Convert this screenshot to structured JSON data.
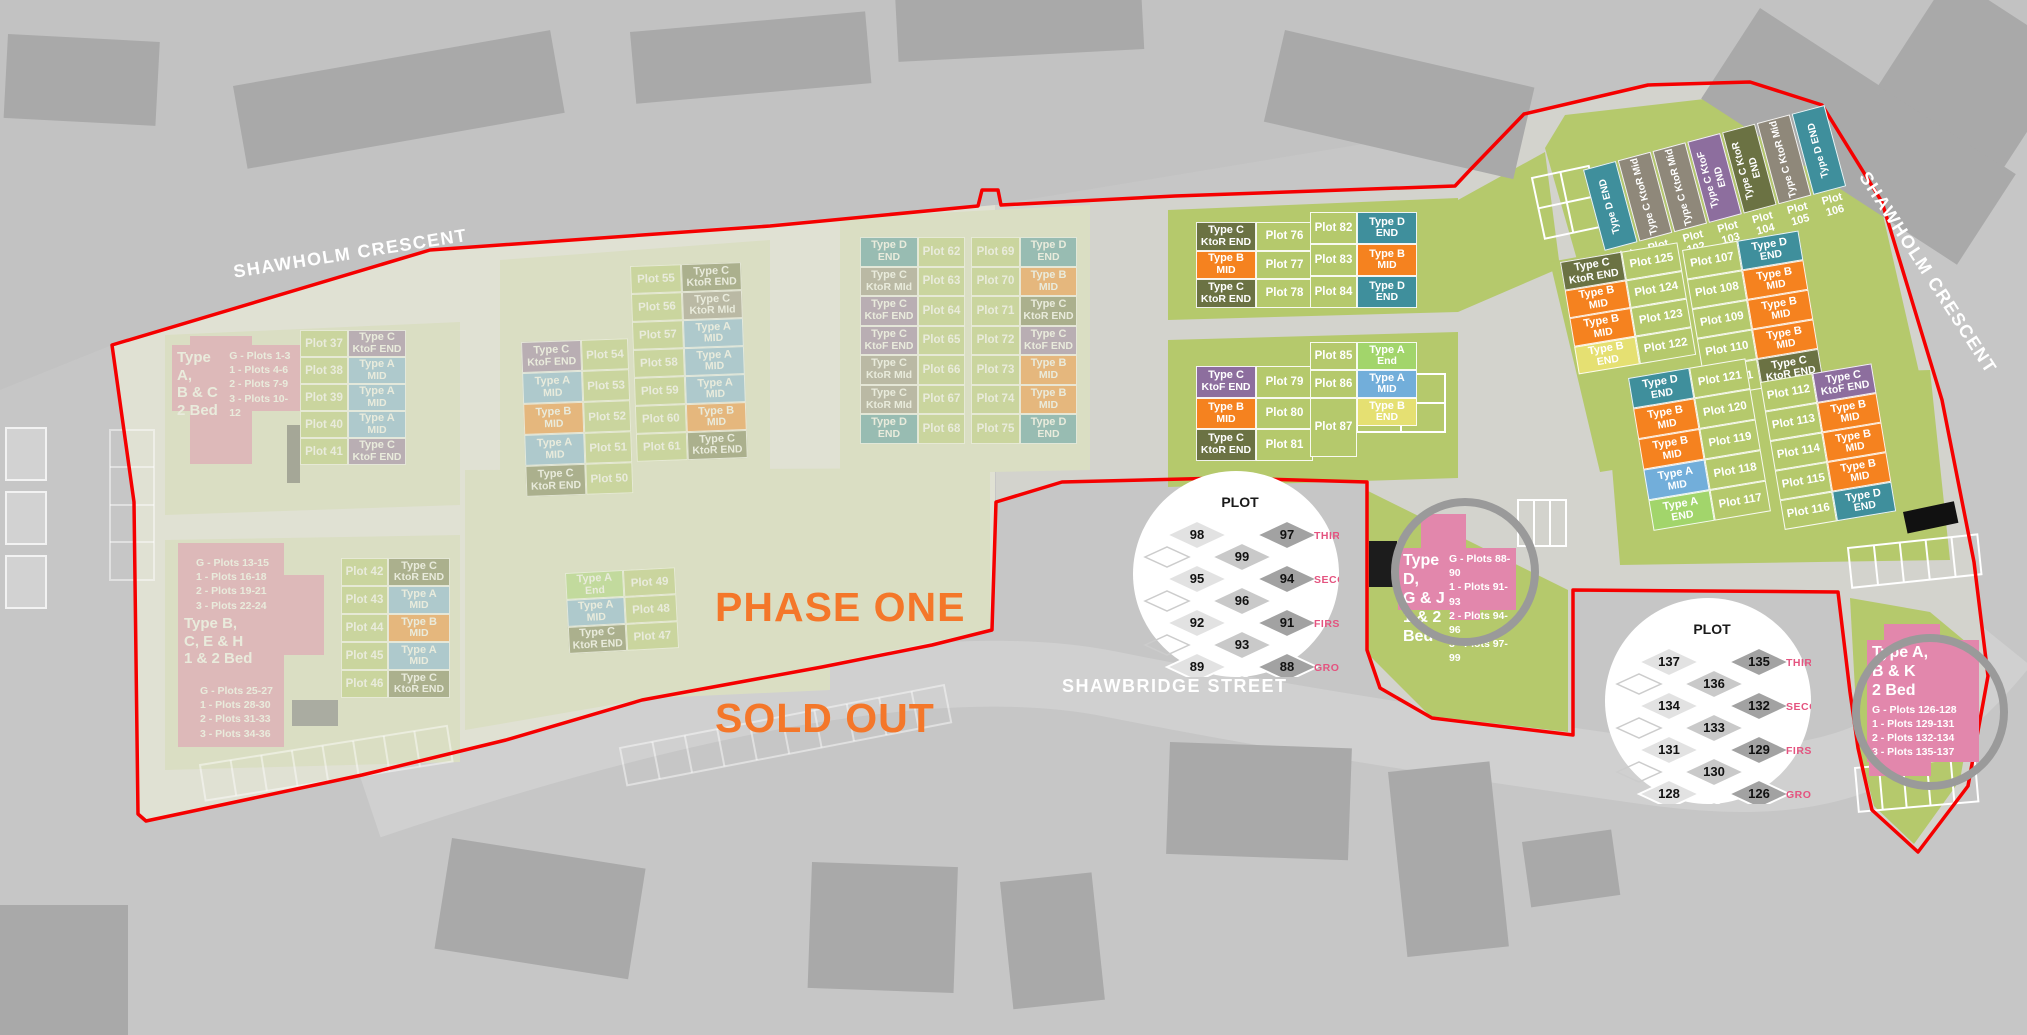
{
  "streets": {
    "shawholm_top": "SHAWHOLM CRESCENT",
    "shawholm_right": "SHAWHOLM CRESCENT",
    "shawbridge": "SHAWBRIDGE STREET"
  },
  "banner": {
    "line1": "PHASE ONE",
    "line2": "SOLD OUT"
  },
  "type_colors": {
    "A_MID": "#72AEDA",
    "A_END": "#A2D56B",
    "B_MID": "#F5821F",
    "B_END": "#E5E072",
    "C_KTOR_END": "#6B7243",
    "C_KTOR_MID": "#8F887A",
    "C_KTOF_END": "#8D6E9E",
    "D_END": "#3F8F9C"
  },
  "palette": {
    "plot_green": "#B5C96C",
    "boundary_red": "#F50000",
    "info_pink": "#E287AC",
    "floor_label_pink": "#E4537F",
    "banner_orange": "#F4772A"
  },
  "clusters": [
    {
      "id": "c76",
      "rows": [
        {
          "plot": "Plot 76",
          "l1": "Type C",
          "l2": "KtoR END",
          "c": "C_KTOR_END"
        },
        {
          "plot": "Plot 77",
          "l1": "Type B",
          "l2": "MID",
          "c": "B_MID"
        },
        {
          "plot": "Plot 78",
          "l1": "Type C",
          "l2": "KtoR END",
          "c": "C_KTOR_END"
        }
      ]
    },
    {
      "id": "c82",
      "rows": [
        {
          "plot": "Plot 82",
          "l1": "Type D",
          "l2": "END",
          "c": "D_END"
        },
        {
          "plot": "Plot 83",
          "l1": "Type B",
          "l2": "MID",
          "c": "B_MID"
        },
        {
          "plot": "Plot 84",
          "l1": "Type D",
          "l2": "END",
          "c": "D_END"
        }
      ]
    },
    {
      "id": "c79",
      "rows": [
        {
          "plot": "Plot 79",
          "l1": "Type C",
          "l2": "KtoF END",
          "c": "C_KTOF_END"
        },
        {
          "plot": "Plot 80",
          "l1": "Type B",
          "l2": "MID",
          "c": "B_MID"
        },
        {
          "plot": "Plot 81",
          "l1": "Type C",
          "l2": "KtoR END",
          "c": "C_KTOR_END"
        }
      ]
    },
    {
      "id": "c85",
      "rows": [
        {
          "plot": "Plot 85",
          "l1": "Type A",
          "l2": "End",
          "c": "A_END"
        },
        {
          "plot": "Plot 86",
          "l1": "Type A",
          "l2": "MID",
          "c": "A_MID"
        },
        {
          "plot": "Plot 87",
          "l1": "Type B",
          "l2": "END",
          "c": "B_END"
        }
      ]
    },
    {
      "id": "c100",
      "rows": [
        {
          "plot": "Plot 100",
          "l1": "Type D",
          "l2": "END",
          "c": "D_END"
        },
        {
          "plot": "Plot 101",
          "l1": "Type C",
          "l2": "KtoR Mid",
          "c": "C_KTOR_MID"
        },
        {
          "plot": "Plot 102",
          "l1": "Type C",
          "l2": "KtoR Mid",
          "c": "C_KTOR_MID"
        },
        {
          "plot": "Plot 103",
          "l1": "Type C",
          "l2": "KtoF END",
          "c": "C_KTOF_END"
        },
        {
          "plot": "Plot 104",
          "l1": "Type C",
          "l2": "KtoR END",
          "c": "C_KTOR_END"
        },
        {
          "plot": "Plot 105",
          "l1": "Type C",
          "l2": "KtoR Mid",
          "c": "C_KTOR_MID"
        },
        {
          "plot": "Plot 106",
          "l1": "Type D",
          "l2": "END",
          "c": "D_END"
        }
      ]
    },
    {
      "id": "c125",
      "rows": [
        {
          "plot": "Plot 125",
          "l1": "Type C",
          "l2": "KtoR END",
          "c": "C_KTOR_END"
        },
        {
          "plot": "Plot 124",
          "l1": "Type B",
          "l2": "MID",
          "c": "B_MID"
        },
        {
          "plot": "Plot 123",
          "l1": "Type B",
          "l2": "MID",
          "c": "B_MID"
        },
        {
          "plot": "Plot 122",
          "l1": "Type B",
          "l2": "END",
          "c": "B_END"
        }
      ]
    },
    {
      "id": "c107",
      "rows": [
        {
          "plot": "Plot 107",
          "l1": "Type D",
          "l2": "END",
          "c": "D_END"
        },
        {
          "plot": "Plot 108",
          "l1": "Type B",
          "l2": "MID",
          "c": "B_MID"
        },
        {
          "plot": "Plot 109",
          "l1": "Type B",
          "l2": "MID",
          "c": "B_MID"
        },
        {
          "plot": "Plot 110",
          "l1": "Type B",
          "l2": "MID",
          "c": "B_MID"
        },
        {
          "plot": "Plot 111",
          "l1": "Type C",
          "l2": "KtoR END",
          "c": "C_KTOR_END"
        }
      ]
    },
    {
      "id": "c121",
      "rows": [
        {
          "plot": "Plot 121",
          "l1": "Type D",
          "l2": "END",
          "c": "D_END"
        },
        {
          "plot": "Plot 120",
          "l1": "Type B",
          "l2": "MID",
          "c": "B_MID"
        },
        {
          "plot": "Plot 119",
          "l1": "Type B",
          "l2": "MID",
          "c": "B_MID"
        },
        {
          "plot": "Plot 118",
          "l1": "Type A",
          "l2": "MID",
          "c": "A_MID"
        },
        {
          "plot": "Plot 117",
          "l1": "Type A",
          "l2": "END",
          "c": "A_END"
        }
      ]
    },
    {
      "id": "c112",
      "rows": [
        {
          "plot": "Plot 112",
          "l1": "Type C",
          "l2": "KtoF END",
          "c": "C_KTOF_END"
        },
        {
          "plot": "Plot 113",
          "l1": "Type B",
          "l2": "MID",
          "c": "B_MID"
        },
        {
          "plot": "Plot 114",
          "l1": "Type B",
          "l2": "MID",
          "c": "B_MID"
        },
        {
          "plot": "Plot 115",
          "l1": "Type B",
          "l2": "MID",
          "c": "B_MID"
        },
        {
          "plot": "Plot 116",
          "l1": "Type D",
          "l2": "END",
          "c": "D_END"
        }
      ]
    },
    {
      "id": "f37",
      "faded": true,
      "rows": [
        {
          "plot": "Plot 37",
          "l1": "Type C",
          "l2": "KtoF END",
          "c": "C_KTOF_END"
        },
        {
          "plot": "Plot 38",
          "l1": "Type A",
          "l2": "MID",
          "c": "A_MID"
        },
        {
          "plot": "Plot 39",
          "l1": "Type A",
          "l2": "MID",
          "c": "A_MID"
        },
        {
          "plot": "Plot 40",
          "l1": "Type A",
          "l2": "MID",
          "c": "A_MID"
        },
        {
          "plot": "Plot 41",
          "l1": "Type C",
          "l2": "KtoF END",
          "c": "C_KTOF_END"
        }
      ]
    },
    {
      "id": "f54",
      "faded": true,
      "rows": [
        {
          "plot": "Plot 54",
          "l1": "Type C",
          "l2": "KtoF END",
          "c": "C_KTOF_END"
        },
        {
          "plot": "Plot 53",
          "l1": "Type A",
          "l2": "MID",
          "c": "A_MID"
        },
        {
          "plot": "Plot 52",
          "l1": "Type B",
          "l2": "MID",
          "c": "B_MID"
        },
        {
          "plot": "Plot 51",
          "l1": "Type A",
          "l2": "MID",
          "c": "A_MID"
        },
        {
          "plot": "Plot 50",
          "l1": "Type C",
          "l2": "KtoR END",
          "c": "C_KTOR_END"
        }
      ]
    },
    {
      "id": "f55",
      "faded": true,
      "rows": [
        {
          "plot": "Plot 55",
          "l1": "Type C",
          "l2": "KtoR END",
          "c": "C_KTOR_END"
        },
        {
          "plot": "Plot 56",
          "l1": "Type C",
          "l2": "KtoR MId",
          "c": "C_KTOR_MID"
        },
        {
          "plot": "Plot 57",
          "l1": "Type A",
          "l2": "MID",
          "c": "A_MID"
        },
        {
          "plot": "Plot 58",
          "l1": "Type A",
          "l2": "MID",
          "c": "A_MID"
        },
        {
          "plot": "Plot 59",
          "l1": "Type A",
          "l2": "MID",
          "c": "A_MID"
        },
        {
          "plot": "Plot 60",
          "l1": "Type B",
          "l2": "MID",
          "c": "B_MID"
        },
        {
          "plot": "Plot 61",
          "l1": "Type C",
          "l2": "KtoR END",
          "c": "C_KTOR_END"
        }
      ]
    },
    {
      "id": "f62",
      "faded": true,
      "rows": [
        {
          "plot": "Plot 62",
          "l1": "Type D",
          "l2": "END",
          "c": "D_END"
        },
        {
          "plot": "Plot 63",
          "l1": "Type C",
          "l2": "KtoR MId",
          "c": "C_KTOR_MID"
        },
        {
          "plot": "Plot 64",
          "l1": "Type C",
          "l2": "KtoF END",
          "c": "C_KTOF_END"
        },
        {
          "plot": "Plot 65",
          "l1": "Type C",
          "l2": "KtoF END",
          "c": "C_KTOF_END"
        },
        {
          "plot": "Plot 66",
          "l1": "Type C",
          "l2": "KtoR MId",
          "c": "C_KTOR_MID"
        },
        {
          "plot": "Plot 67",
          "l1": "Type C",
          "l2": "KtoR MId",
          "c": "C_KTOR_MID"
        },
        {
          "plot": "Plot 68",
          "l1": "Type D",
          "l2": "END",
          "c": "D_END"
        }
      ]
    },
    {
      "id": "f69",
      "faded": true,
      "rows": [
        {
          "plot": "Plot 69",
          "l1": "Type D",
          "l2": "END",
          "c": "D_END"
        },
        {
          "plot": "Plot 70",
          "l1": "Type B",
          "l2": "MID",
          "c": "B_MID"
        },
        {
          "plot": "Plot 71",
          "l1": "Type C",
          "l2": "KtoR END",
          "c": "C_KTOR_END"
        },
        {
          "plot": "Plot 72",
          "l1": "Type C",
          "l2": "KtoF END",
          "c": "C_KTOF_END"
        },
        {
          "plot": "Plot 73",
          "l1": "Type B",
          "l2": "MID",
          "c": "B_MID"
        },
        {
          "plot": "Plot 74",
          "l1": "Type B",
          "l2": "MID",
          "c": "B_MID"
        },
        {
          "plot": "Plot 75",
          "l1": "Type D",
          "l2": "END",
          "c": "D_END"
        }
      ]
    },
    {
      "id": "f42",
      "faded": true,
      "rows": [
        {
          "plot": "Plot 42",
          "l1": "Type C",
          "l2": "KtoR END",
          "c": "C_KTOR_END"
        },
        {
          "plot": "Plot 43",
          "l1": "Type A",
          "l2": "MID",
          "c": "A_MID"
        },
        {
          "plot": "Plot 44",
          "l1": "Type B",
          "l2": "MID",
          "c": "B_MID"
        },
        {
          "plot": "Plot 45",
          "l1": "Type A",
          "l2": "MID",
          "c": "A_MID"
        },
        {
          "plot": "Plot 46",
          "l1": "Type C",
          "l2": "KtoR END",
          "c": "C_KTOR_END"
        }
      ]
    },
    {
      "id": "f49",
      "faded": true,
      "rows": [
        {
          "plot": "Plot 49",
          "l1": "Type A",
          "l2": "End",
          "c": "A_END"
        },
        {
          "plot": "Plot 48",
          "l1": "Type A",
          "l2": "MID",
          "c": "A_MID"
        },
        {
          "plot": "Plot 47",
          "l1": "Type C",
          "l2": "KtoR END",
          "c": "C_KTOR_END"
        }
      ]
    }
  ],
  "info_boxes": {
    "p1": {
      "title": [
        "Type A,",
        "B & C",
        "2 Bed"
      ],
      "list": [
        "G - Plots 1-3",
        "1 - Plots 4-6",
        "2 - Plots 7-9",
        "3 - Plots 10-12"
      ]
    },
    "p2": {
      "title": [
        "Type B,",
        "C, E & H",
        "1 & 2 Bed"
      ],
      "list_top": [
        "G - Plots 13-15",
        "1 - Plots 16-18",
        "2 - Plots 19-21",
        "3 - Plots 22-24"
      ],
      "list_bottom": [
        "G - Plots 25-27",
        "1 - Plots 28-30",
        "2 - Plots 31-33",
        "3 - Plots 34-36"
      ]
    },
    "p3": {
      "title": [
        "Type D,",
        "G & J",
        "1 & 2",
        "Bed"
      ],
      "list": [
        "G - Plots 88-90",
        "1 - Plots 91-93",
        "2 - Plots 94-96",
        "3 - Plots 97-99"
      ]
    },
    "p4": {
      "title": [
        "Type A,",
        "B & K",
        "2 Bed"
      ],
      "list": [
        "G - Plots 126-128",
        "1 - Plots 129-131",
        "2 - Plots 132-134",
        "3 - Plots 135-137"
      ]
    }
  },
  "floor_diagrams": [
    {
      "id": "d1",
      "title": "PLOT",
      "floors": [
        {
          "label": "THIRD",
          "left": "98",
          "right": "97",
          "mid": "99"
        },
        {
          "label": "SECOND",
          "left": "95",
          "right": "94",
          "mid": "96"
        },
        {
          "label": "FIRST",
          "left": "92",
          "right": "91",
          "mid": "93"
        },
        {
          "label": "GROUND",
          "left": "89",
          "right": "88",
          "mid": "90"
        }
      ]
    },
    {
      "id": "d2",
      "title": "PLOT",
      "floors": [
        {
          "label": "THIRD",
          "left": "137",
          "right": "135",
          "mid": "136"
        },
        {
          "label": "SECOND",
          "left": "134",
          "right": "132",
          "mid": "133"
        },
        {
          "label": "FIRST",
          "left": "131",
          "right": "129",
          "mid": "130"
        },
        {
          "label": "GROUND",
          "left": "128",
          "right": "126",
          "mid": "127"
        }
      ]
    }
  ]
}
